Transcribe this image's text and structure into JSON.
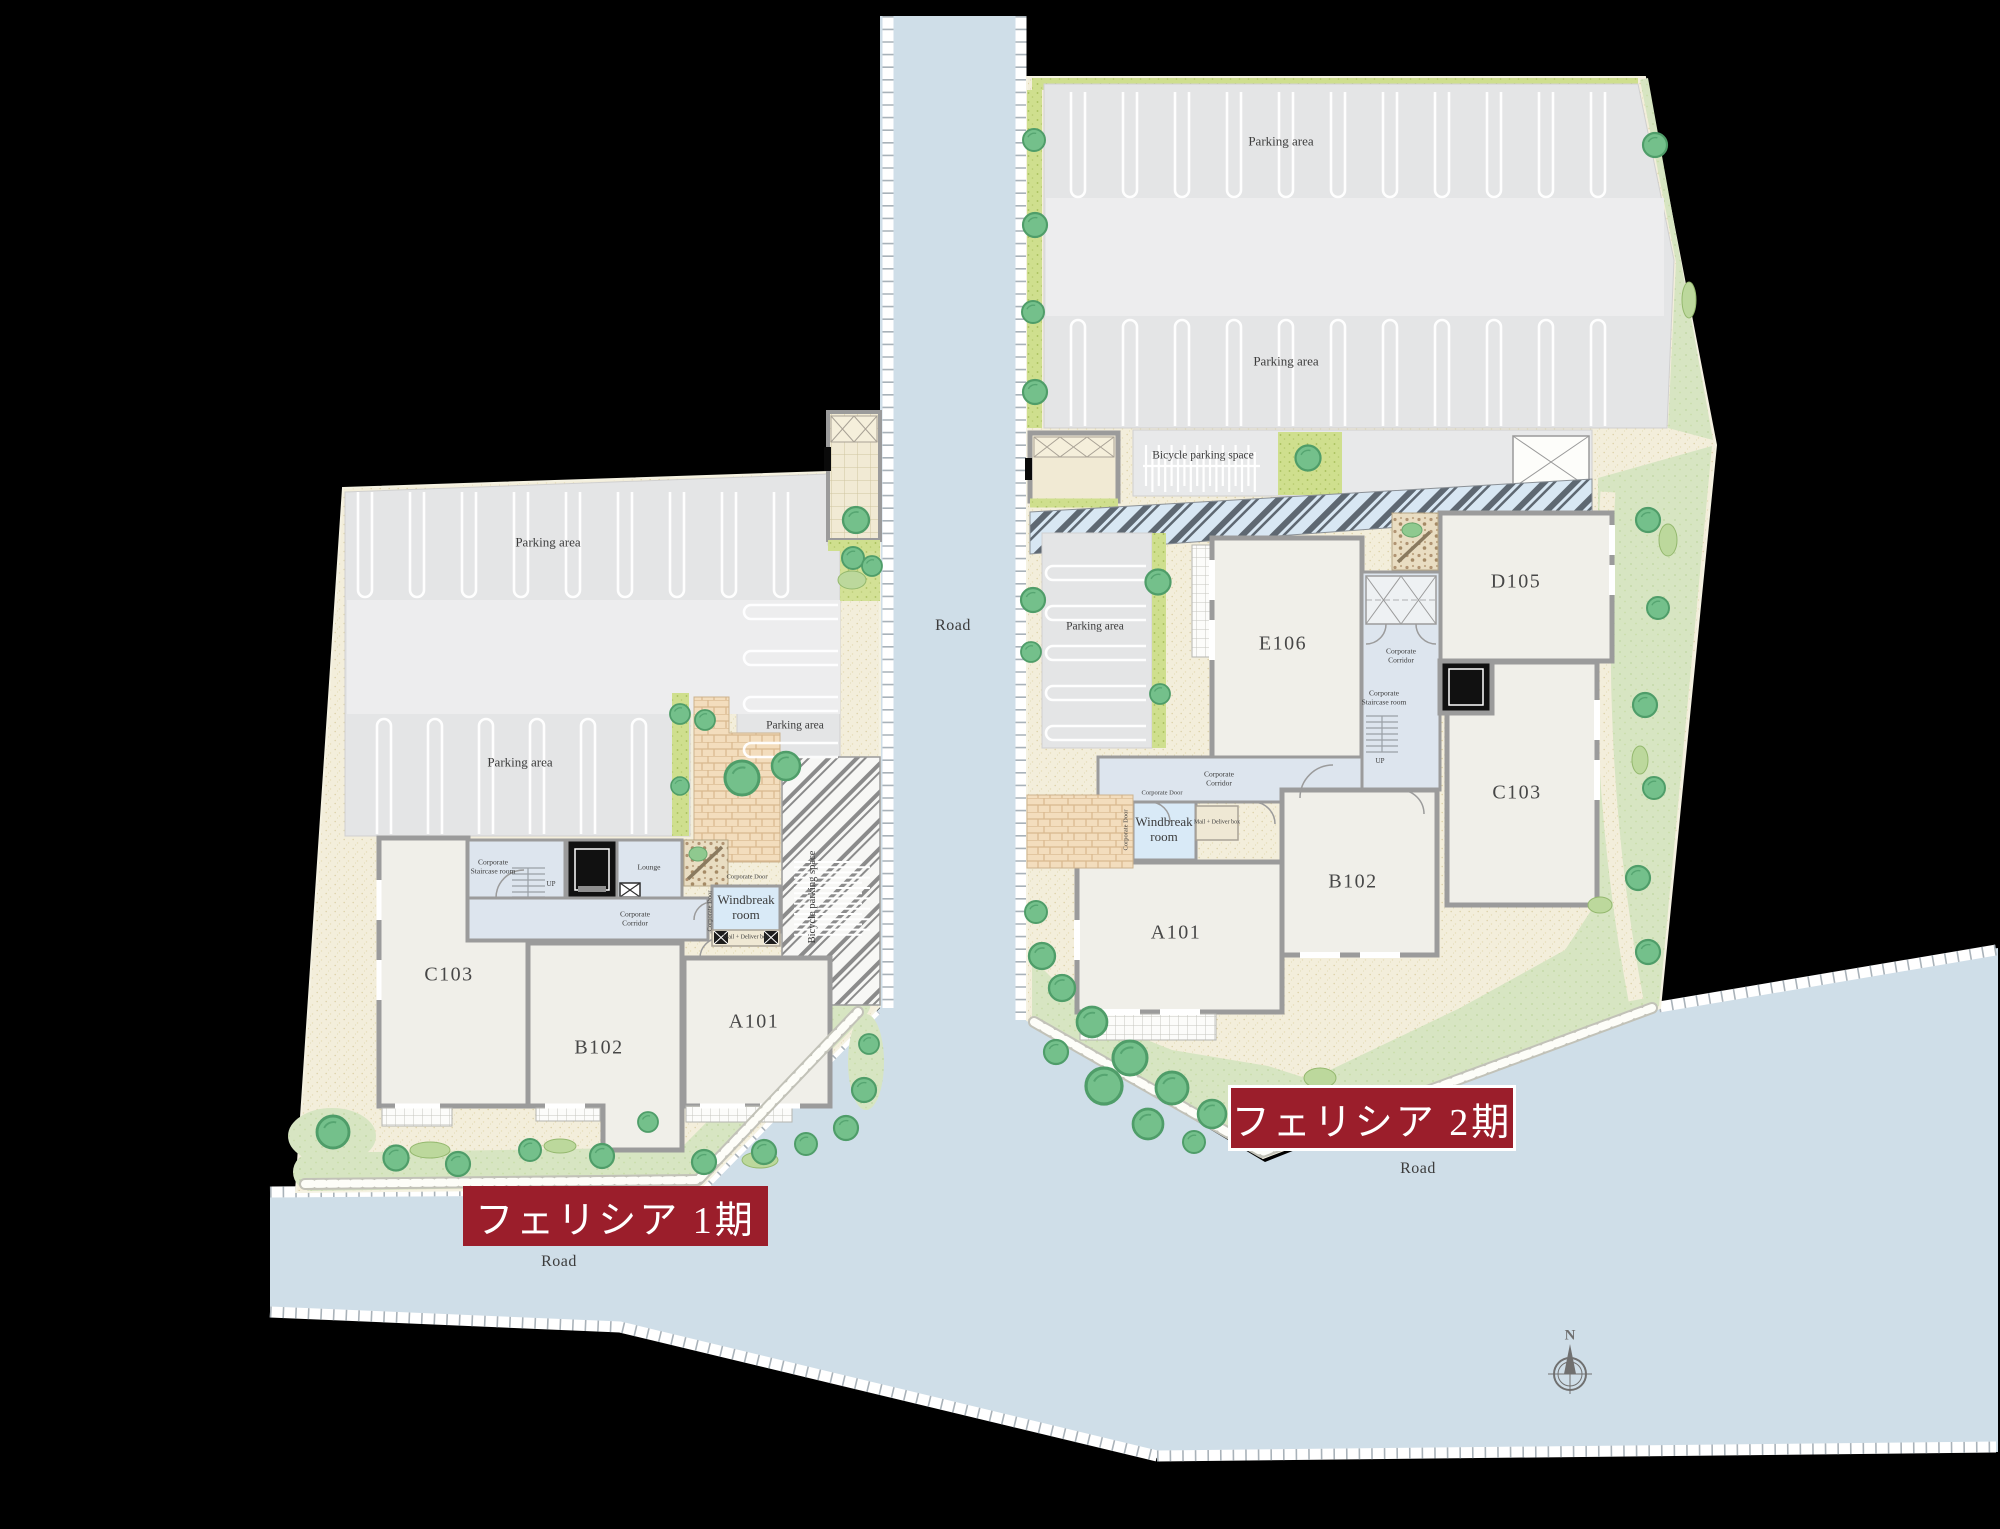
{
  "banners": {
    "phase1": "フェリシア 1期",
    "phase2": "フェリシア 2期"
  },
  "labels": {
    "road": "Road",
    "parking_area": "Parking area",
    "bicycle_parking": "Bicycle parking space",
    "windbreak_room": "Windbreak room",
    "corporate_corridor": "Corporate Corridor",
    "corporate_staircase_room": "Corporate Staircase room",
    "corporate_door": "Corporate Door",
    "lounge": "Lounge",
    "mail_box": "Mail + Deliver box",
    "up": "UP",
    "compass_north": "N"
  },
  "phase1": {
    "rooms": {
      "a101": "A101",
      "b102": "B102",
      "c103": "C103"
    }
  },
  "phase2": {
    "rooms": {
      "a101": "A101",
      "b102": "B102",
      "c103": "C103",
      "d105": "D105",
      "e106": "E106"
    }
  },
  "colors": {
    "background": "#000000",
    "banner_red": "#9B1E2B",
    "road": "#CFDEE8",
    "parking": "#E4E5E6",
    "sand": "#F3EEDB",
    "lawn": "#D7E5C2",
    "tree": "#74C08B",
    "wall": "#9B9B9B",
    "corridor": "#DDE5EE",
    "windbreak": "#D9EAF7"
  }
}
